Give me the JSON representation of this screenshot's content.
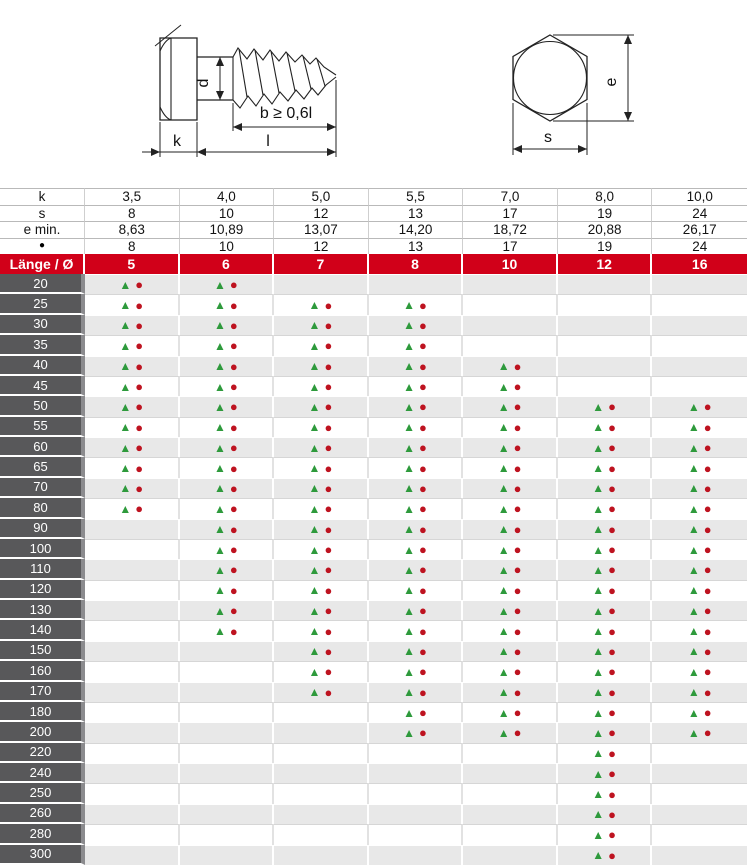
{
  "drawing": {
    "screw_side_view": {
      "dim_d": "d",
      "dim_b": "b ≥ 0,6l",
      "dim_k": "k",
      "dim_l": "l"
    },
    "head_top_view": {
      "dim_e": "e",
      "dim_s": "s"
    }
  },
  "table": {
    "header_rows": [
      {
        "label": "k",
        "values": [
          "3,5",
          "4,0",
          "5,0",
          "5,5",
          "7,0",
          "8,0",
          "10,0"
        ]
      },
      {
        "label": "s",
        "values": [
          "8",
          "10",
          "12",
          "13",
          "17",
          "19",
          "24"
        ]
      },
      {
        "label": "e min.",
        "values": [
          "8,63",
          "10,89",
          "13,07",
          "14,20",
          "18,72",
          "20,88",
          "26,17"
        ]
      },
      {
        "label": "●",
        "values": [
          "8",
          "10",
          "12",
          "13",
          "17",
          "19",
          "24"
        ]
      }
    ],
    "diameter_row": {
      "label": "Länge / Ø",
      "values": [
        "5",
        "6",
        "7",
        "8",
        "10",
        "12",
        "16"
      ]
    },
    "markers": {
      "available_triangle": "▲",
      "available_circle": "●"
    },
    "rows": [
      {
        "length": "20",
        "available": [
          1,
          1,
          0,
          0,
          0,
          0,
          0
        ]
      },
      {
        "length": "25",
        "available": [
          1,
          1,
          1,
          1,
          0,
          0,
          0
        ]
      },
      {
        "length": "30",
        "available": [
          1,
          1,
          1,
          1,
          0,
          0,
          0
        ]
      },
      {
        "length": "35",
        "available": [
          1,
          1,
          1,
          1,
          0,
          0,
          0
        ]
      },
      {
        "length": "40",
        "available": [
          1,
          1,
          1,
          1,
          1,
          0,
          0
        ]
      },
      {
        "length": "45",
        "available": [
          1,
          1,
          1,
          1,
          1,
          0,
          0
        ]
      },
      {
        "length": "50",
        "available": [
          1,
          1,
          1,
          1,
          1,
          1,
          1
        ]
      },
      {
        "length": "55",
        "available": [
          1,
          1,
          1,
          1,
          1,
          1,
          1
        ]
      },
      {
        "length": "60",
        "available": [
          1,
          1,
          1,
          1,
          1,
          1,
          1
        ]
      },
      {
        "length": "65",
        "available": [
          1,
          1,
          1,
          1,
          1,
          1,
          1
        ]
      },
      {
        "length": "70",
        "available": [
          1,
          1,
          1,
          1,
          1,
          1,
          1
        ]
      },
      {
        "length": "80",
        "available": [
          1,
          1,
          1,
          1,
          1,
          1,
          1
        ]
      },
      {
        "length": "90",
        "available": [
          0,
          1,
          1,
          1,
          1,
          1,
          1
        ]
      },
      {
        "length": "100",
        "available": [
          0,
          1,
          1,
          1,
          1,
          1,
          1
        ]
      },
      {
        "length": "110",
        "available": [
          0,
          1,
          1,
          1,
          1,
          1,
          1
        ]
      },
      {
        "length": "120",
        "available": [
          0,
          1,
          1,
          1,
          1,
          1,
          1
        ]
      },
      {
        "length": "130",
        "available": [
          0,
          1,
          1,
          1,
          1,
          1,
          1
        ]
      },
      {
        "length": "140",
        "available": [
          0,
          1,
          1,
          1,
          1,
          1,
          1
        ]
      },
      {
        "length": "150",
        "available": [
          0,
          0,
          1,
          1,
          1,
          1,
          1
        ]
      },
      {
        "length": "160",
        "available": [
          0,
          0,
          1,
          1,
          1,
          1,
          1
        ]
      },
      {
        "length": "170",
        "available": [
          0,
          0,
          1,
          1,
          1,
          1,
          1
        ]
      },
      {
        "length": "180",
        "available": [
          0,
          0,
          0,
          1,
          1,
          1,
          1
        ]
      },
      {
        "length": "200",
        "available": [
          0,
          0,
          0,
          1,
          1,
          1,
          1
        ]
      },
      {
        "length": "220",
        "available": [
          0,
          0,
          0,
          0,
          0,
          1,
          0
        ]
      },
      {
        "length": "240",
        "available": [
          0,
          0,
          0,
          0,
          0,
          1,
          0
        ]
      },
      {
        "length": "250",
        "available": [
          0,
          0,
          0,
          0,
          0,
          1,
          0
        ]
      },
      {
        "length": "260",
        "available": [
          0,
          0,
          0,
          0,
          0,
          1,
          0
        ]
      },
      {
        "length": "280",
        "available": [
          0,
          0,
          0,
          0,
          0,
          1,
          0
        ]
      },
      {
        "length": "300",
        "available": [
          0,
          0,
          0,
          0,
          0,
          1,
          0
        ]
      }
    ]
  },
  "colors": {
    "header_red": "#d10019",
    "row_label_gray": "#58585a",
    "row_alt_gray": "#e8e8e8",
    "triangle_green": "#2e9a3c",
    "circle_red": "#be1320"
  }
}
